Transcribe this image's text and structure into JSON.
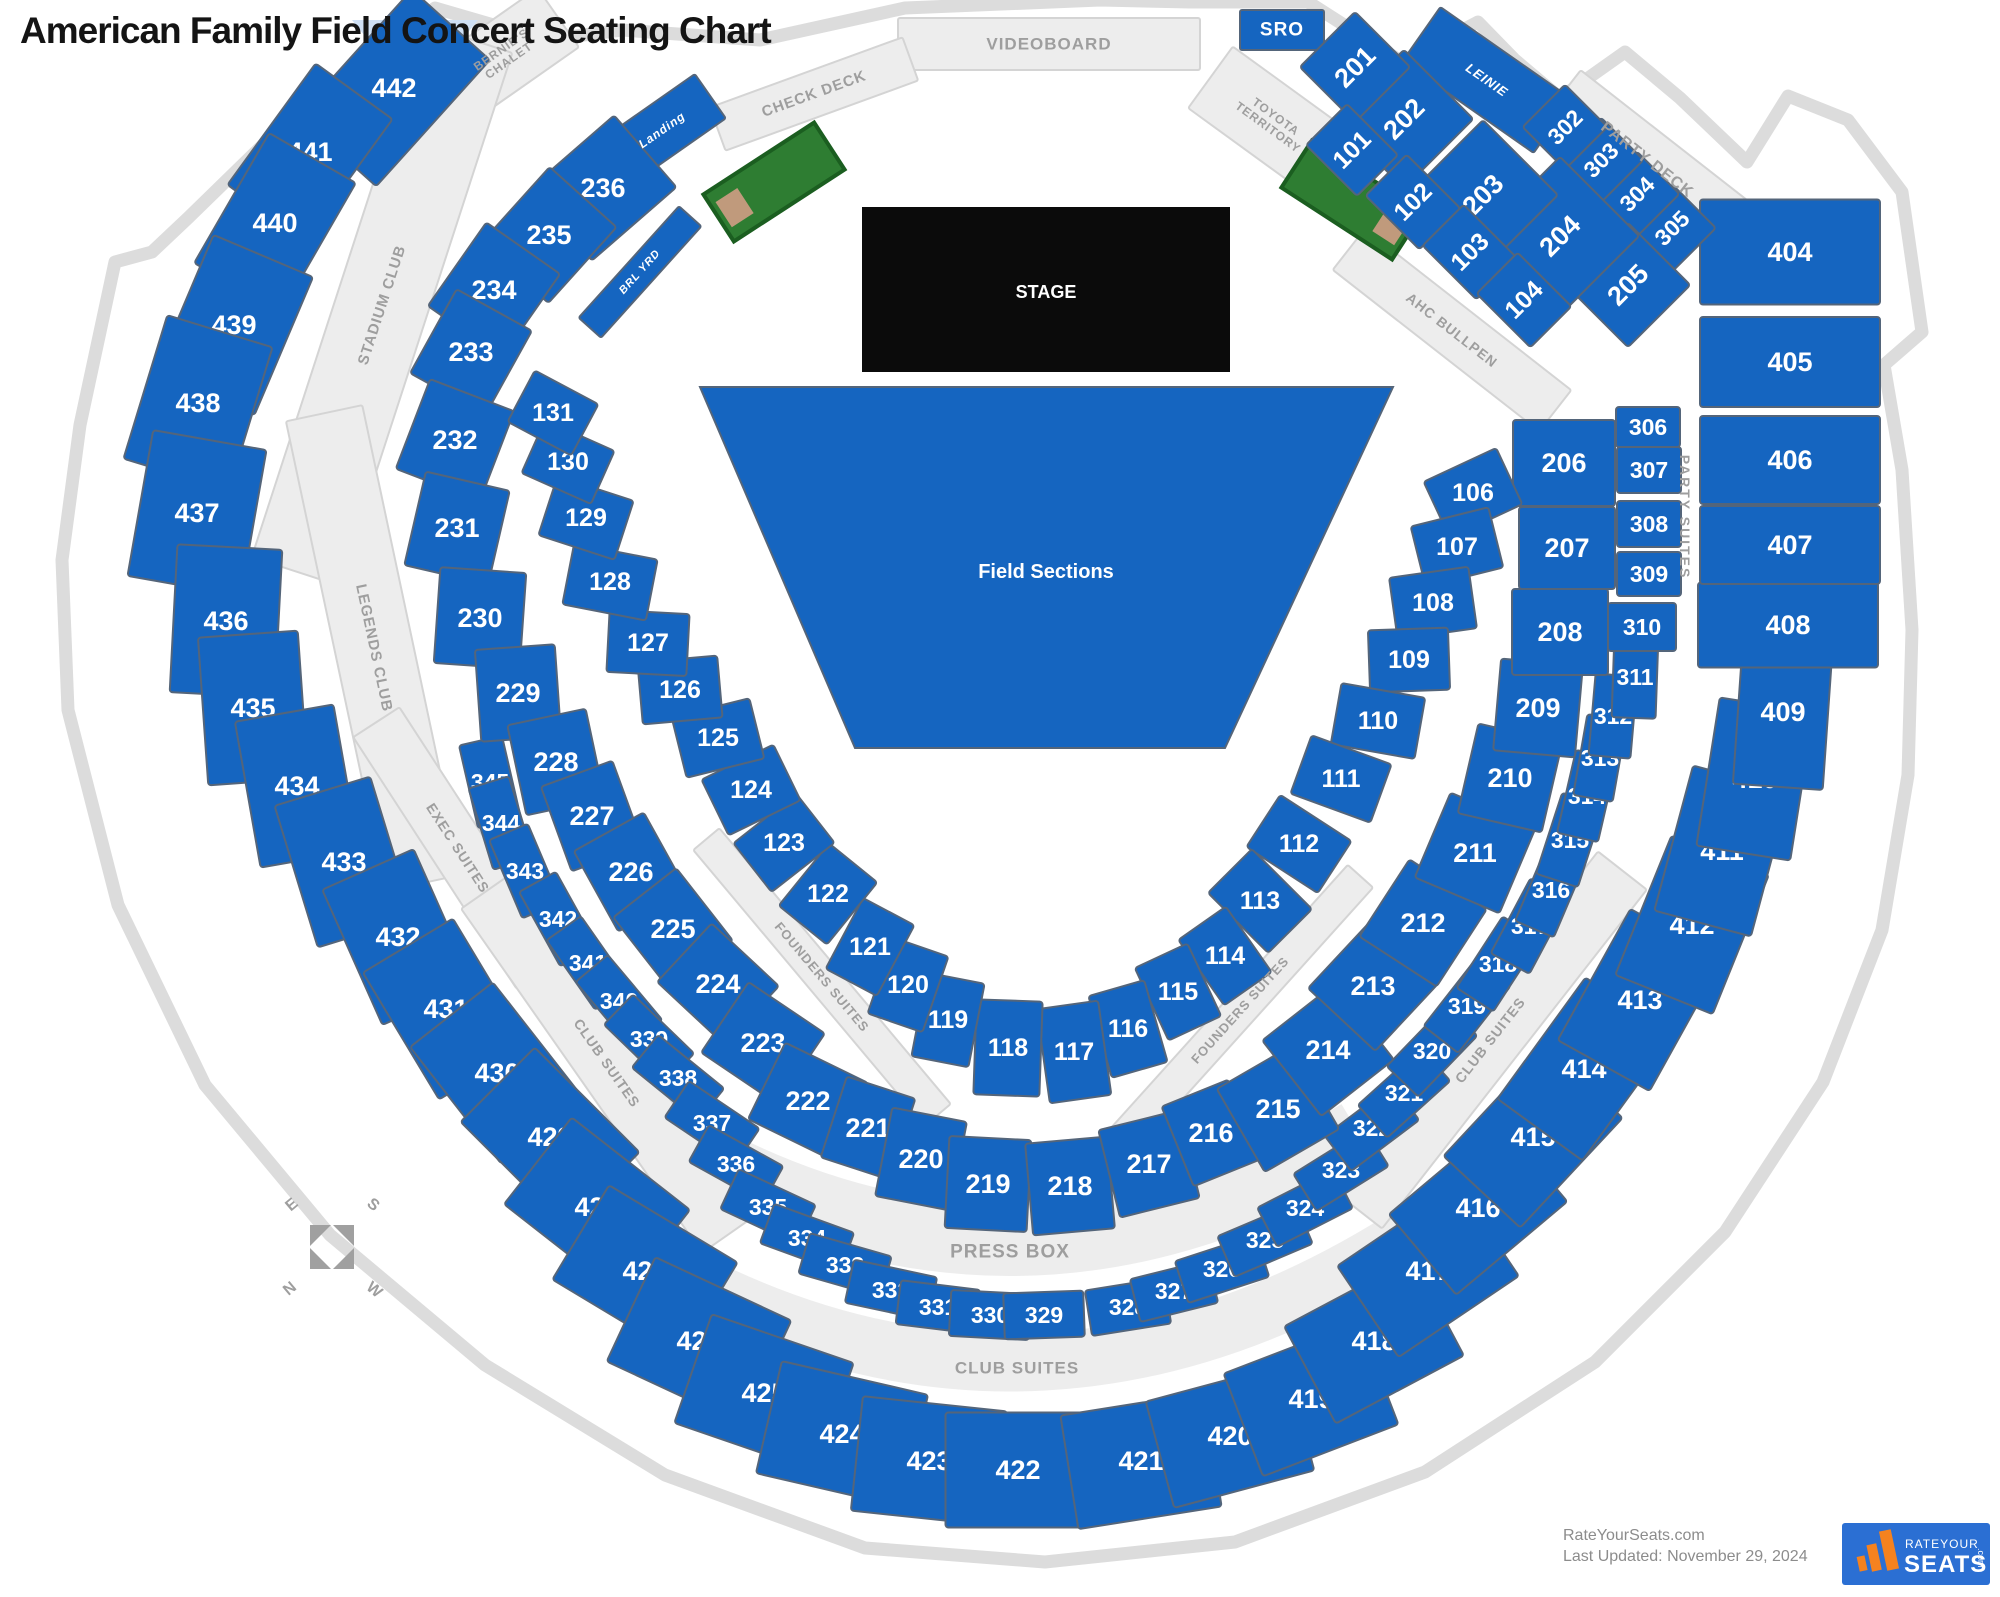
{
  "page": {
    "title": "American Family Field Concert Seating Chart"
  },
  "stage": {
    "label": "STAGE"
  },
  "field": {
    "label": "Field Sections"
  },
  "press_box": {
    "label": "PRESS BOX"
  },
  "club_suites_lower": {
    "label": "CLUB SUITES"
  },
  "compass": {
    "n": "N",
    "e": "E",
    "s": "S",
    "w": "W"
  },
  "footer": {
    "site": "RateYourSeats.com",
    "updated": "Last Updated: November 29, 2024"
  },
  "logo": {
    "rate_your": "RATEYOUR",
    "seats": "SEATS",
    "com": ".com"
  },
  "colors": {
    "section_blue": "#1565c0",
    "section_border": "#54657a",
    "band_gray": "#ededed",
    "band_border": "#d4d4d4",
    "gray_text": "#9e9e9e",
    "stage_black": "#0b0b0b",
    "bullpen_green": "#2e7d32",
    "bullpen_dark": "#1b5e20",
    "mound_tan": "#c09a7c",
    "logo_blue": "#2b6fd3",
    "logo_orange": "#f5821f",
    "outline_gray": "#dcdcdc",
    "light_blue": "#cfe0f5",
    "white": "#ffffff"
  },
  "bullpens": [
    {
      "cx": 774,
      "cy": 182,
      "w": 132,
      "h": 56,
      "rot": -33,
      "patch": "left"
    },
    {
      "cx": 1352,
      "cy": 200,
      "w": 132,
      "h": 56,
      "rot": 33,
      "patch": "right"
    }
  ],
  "bands": [
    [
      "VIDEOBOARD",
      1049,
      44,
      302,
      52,
      0,
      "gray",
      17
    ],
    [
      "SRO",
      1282,
      30,
      84,
      40,
      0,
      "blue",
      19
    ],
    [
      "CHECK DECK",
      814,
      94,
      205,
      46,
      -20,
      "gray",
      15
    ],
    [
      "BERNIE'S\nCHALET",
      505,
      55,
      130,
      72,
      -35,
      "gray",
      12
    ],
    [
      "TOYOTA\nTERRITORY",
      1272,
      122,
      152,
      76,
      36,
      "gray",
      12
    ],
    [
      "Landing",
      662,
      130,
      118,
      54,
      -35,
      "blueItalic",
      12
    ],
    [
      "BRL YRD",
      640,
      272,
      150,
      30,
      -48,
      "blueItalic",
      11
    ],
    [
      "LEINIE",
      1487,
      80,
      160,
      66,
      35,
      "blueItalic",
      13
    ],
    [
      "PARTY DECK",
      1647,
      160,
      215,
      60,
      38,
      "gray",
      16
    ],
    [
      "AHC BULLPEN",
      1452,
      330,
      262,
      52,
      38,
      "gray",
      14
    ],
    [
      "PARTY SUITES",
      1685,
      517,
      170,
      30,
      90,
      "textOnly",
      14
    ],
    [
      "STADIUM CLUB",
      382,
      305,
      560,
      92,
      -72,
      "gray",
      15
    ],
    [
      "LEGENDS CLUB",
      374,
      648,
      480,
      78,
      78,
      "gray",
      15
    ],
    [
      "EXEC SUITES",
      458,
      848,
      300,
      55,
      57,
      "gray",
      14
    ],
    [
      "CLUB SUITES",
      607,
      1063,
      420,
      62,
      55,
      "gray",
      14
    ],
    [
      "FOUNDERS SUITES",
      822,
      977,
      360,
      34,
      50,
      "gray",
      13
    ],
    [
      "FOUNDERS SUITES",
      1240,
      1010,
      360,
      34,
      -48,
      "gray",
      13
    ],
    [
      "CLUB SUITES",
      1490,
      1040,
      430,
      62,
      -52,
      "gray",
      14
    ]
  ],
  "sections": [
    [
      "442",
      394,
      88,
      170,
      105,
      -48
    ],
    [
      "441",
      310,
      152,
      150,
      95,
      -54
    ],
    [
      "440",
      275,
      223,
      150,
      100,
      -60
    ],
    [
      "439",
      234,
      325,
      150,
      108,
      -67
    ],
    [
      "438",
      198,
      403,
      150,
      110,
      -73
    ],
    [
      "437",
      197,
      513,
      148,
      115,
      -80
    ],
    [
      "436",
      226,
      621,
      148,
      105,
      -87
    ],
    [
      "435",
      253,
      708,
      148,
      100,
      86
    ],
    [
      "434",
      297,
      786,
      148,
      100,
      80
    ],
    [
      "433",
      344,
      862,
      148,
      100,
      73
    ],
    [
      "432",
      398,
      937,
      148,
      100,
      66
    ],
    [
      "431",
      446,
      1009,
      148,
      105,
      59
    ],
    [
      "430",
      497,
      1073,
      148,
      105,
      52
    ],
    [
      "429",
      550,
      1137,
      148,
      105,
      45
    ],
    [
      "428",
      597,
      1207,
      150,
      110,
      38
    ],
    [
      "427",
      645,
      1271,
      150,
      110,
      31
    ],
    [
      "426",
      699,
      1341,
      150,
      115,
      25
    ],
    [
      "425",
      764,
      1393,
      150,
      115,
      19
    ],
    [
      "424",
      842,
      1434,
      150,
      115,
      13
    ],
    [
      "423",
      929,
      1461,
      145,
      115,
      6
    ],
    [
      "422",
      1018,
      1470,
      145,
      115,
      0
    ],
    [
      "421",
      1141,
      1461,
      145,
      115,
      -9
    ],
    [
      "420",
      1230,
      1436,
      145,
      110,
      -15
    ],
    [
      "419",
      1311,
      1399,
      145,
      110,
      -21
    ],
    [
      "418",
      1374,
      1341,
      145,
      110,
      -28
    ],
    [
      "417",
      1428,
      1271,
      145,
      110,
      -34
    ],
    [
      "416",
      1478,
      1208,
      145,
      105,
      -40
    ],
    [
      "415",
      1533,
      1137,
      150,
      105,
      -47
    ],
    [
      "414",
      1584,
      1069,
      150,
      105,
      -54
    ],
    [
      "413",
      1640,
      1000,
      150,
      105,
      -61
    ],
    [
      "412",
      1692,
      925,
      150,
      105,
      -68
    ],
    [
      "411",
      1722,
      851,
      150,
      100,
      -75
    ],
    [
      "410",
      1755,
      779,
      150,
      95,
      -81
    ],
    [
      "409",
      1783,
      712,
      150,
      90,
      -86
    ],
    [
      "408",
      1788,
      625,
      180,
      85,
      0
    ],
    [
      "407",
      1790,
      545,
      180,
      78,
      0
    ],
    [
      "406",
      1790,
      460,
      180,
      88,
      0
    ],
    [
      "405",
      1790,
      362,
      180,
      90,
      0
    ],
    [
      "404",
      1790,
      252,
      180,
      105,
      0
    ],
    [
      "345",
      490,
      782,
      85,
      44,
      77
    ],
    [
      "344",
      501,
      823,
      85,
      42,
      73
    ],
    [
      "343",
      525,
      871,
      85,
      42,
      67
    ],
    [
      "342",
      558,
      919,
      85,
      42,
      61
    ],
    [
      "341",
      588,
      963,
      85,
      42,
      55
    ],
    [
      "340",
      619,
      1001,
      85,
      42,
      50
    ],
    [
      "339",
      649,
      1039,
      85,
      42,
      44
    ],
    [
      "338",
      678,
      1078,
      85,
      42,
      39
    ],
    [
      "337",
      712,
      1123,
      85,
      44,
      34
    ],
    [
      "336",
      736,
      1164,
      85,
      42,
      29
    ],
    [
      "335",
      768,
      1207,
      85,
      44,
      25
    ],
    [
      "334",
      807,
      1238,
      85,
      42,
      20
    ],
    [
      "333",
      845,
      1265,
      85,
      42,
      16
    ],
    [
      "332",
      891,
      1290,
      85,
      44,
      12
    ],
    [
      "331",
      938,
      1307,
      80,
      44,
      7
    ],
    [
      "330",
      990,
      1315,
      80,
      46,
      3
    ],
    [
      "329",
      1044,
      1315,
      80,
      46,
      -2
    ],
    [
      "328",
      1128,
      1307,
      80,
      46,
      -9
    ],
    [
      "327",
      1174,
      1291,
      80,
      44,
      -14
    ],
    [
      "326",
      1222,
      1269,
      85,
      44,
      -18
    ],
    [
      "325",
      1265,
      1240,
      85,
      44,
      -23
    ],
    [
      "324",
      1305,
      1208,
      85,
      44,
      -27
    ],
    [
      "323",
      1341,
      1170,
      85,
      44,
      -32
    ],
    [
      "322",
      1372,
      1128,
      85,
      44,
      -37
    ],
    [
      "321",
      1404,
      1093,
      85,
      44,
      -42
    ],
    [
      "320",
      1432,
      1051,
      85,
      44,
      -46
    ],
    [
      "319",
      1467,
      1006,
      85,
      44,
      -52
    ],
    [
      "318",
      1498,
      964,
      85,
      44,
      -57
    ],
    [
      "317",
      1530,
      926,
      85,
      44,
      -62
    ],
    [
      "316",
      1551,
      890,
      85,
      42,
      -67
    ],
    [
      "315",
      1570,
      840,
      85,
      44,
      -72
    ],
    [
      "314",
      1587,
      796,
      85,
      42,
      -77
    ],
    [
      "313",
      1600,
      758,
      82,
      40,
      -80
    ],
    [
      "312",
      1613,
      716,
      82,
      42,
      -85
    ],
    [
      "311",
      1635,
      677,
      82,
      44,
      -88
    ],
    [
      "310",
      1642,
      627,
      68,
      48,
      0
    ],
    [
      "309",
      1649,
      574,
      64,
      44,
      0
    ],
    [
      "308",
      1649,
      524,
      64,
      46,
      0
    ],
    [
      "307",
      1649,
      470,
      64,
      46,
      0
    ],
    [
      "306",
      1648,
      427,
      64,
      40,
      0
    ],
    [
      "305",
      1672,
      228,
      62,
      62,
      -45,
      -45
    ],
    [
      "304",
      1637,
      194,
      60,
      60,
      -45,
      -45
    ],
    [
      "303",
      1601,
      160,
      60,
      60,
      -45,
      -45
    ],
    [
      "302",
      1565,
      127,
      60,
      60,
      -45,
      -45
    ],
    [
      "236",
      603,
      188,
      112,
      95,
      -41
    ],
    [
      "235",
      549,
      235,
      102,
      90,
      -48
    ],
    [
      "234",
      494,
      290,
      102,
      90,
      -55
    ],
    [
      "233",
      471,
      352,
      96,
      86,
      -61
    ],
    [
      "232",
      455,
      440,
      96,
      90,
      -69
    ],
    [
      "231",
      457,
      528,
      96,
      86,
      -77
    ],
    [
      "230",
      480,
      618,
      96,
      86,
      -86
    ],
    [
      "229",
      518,
      693,
      92,
      80,
      86
    ],
    [
      "228",
      556,
      762,
      92,
      80,
      78
    ],
    [
      "227",
      592,
      816,
      90,
      76,
      70
    ],
    [
      "226",
      631,
      872,
      92,
      80,
      61
    ],
    [
      "225",
      673,
      929,
      92,
      80,
      52
    ],
    [
      "224",
      718,
      984,
      92,
      80,
      43
    ],
    [
      "223",
      763,
      1043,
      92,
      85,
      34
    ],
    [
      "222",
      808,
      1101,
      92,
      85,
      26
    ],
    [
      "221",
      868,
      1128,
      72,
      85,
      18
    ],
    [
      "220",
      921,
      1159,
      76,
      90,
      11
    ],
    [
      "219",
      988,
      1184,
      82,
      92,
      3
    ],
    [
      "218",
      1070,
      1186,
      82,
      92,
      -5
    ],
    [
      "217",
      1149,
      1164,
      82,
      90,
      -14
    ],
    [
      "216",
      1211,
      1133,
      72,
      86,
      -22
    ],
    [
      "215",
      1278,
      1109,
      86,
      96,
      -30
    ],
    [
      "214",
      1328,
      1050,
      92,
      96,
      -38
    ],
    [
      "213",
      1373,
      986,
      92,
      92,
      -47
    ],
    [
      "212",
      1423,
      923,
      92,
      92,
      -57
    ],
    [
      "211",
      1475,
      853,
      92,
      92,
      -67
    ],
    [
      "210",
      1510,
      778,
      92,
      86,
      -77
    ],
    [
      "209",
      1538,
      708,
      92,
      82,
      -85
    ],
    [
      "208",
      1560,
      632,
      96,
      86,
      0
    ],
    [
      "207",
      1567,
      548,
      96,
      82,
      0
    ],
    [
      "206",
      1564,
      463,
      102,
      86,
      0
    ],
    [
      "205",
      1628,
      285,
      88,
      88,
      -45,
      -45
    ],
    [
      "204",
      1560,
      236,
      112,
      112,
      -45,
      -45
    ],
    [
      "203",
      1483,
      195,
      106,
      106,
      -45,
      -45
    ],
    [
      "202",
      1404,
      119,
      98,
      98,
      -45,
      -45
    ],
    [
      "201",
      1355,
      67,
      78,
      78,
      -45,
      -45
    ],
    [
      "101",
      1352,
      150,
      58,
      72,
      -45,
      -45
    ],
    [
      "102",
      1413,
      202,
      58,
      76,
      -45,
      -45
    ],
    [
      "103",
      1470,
      252,
      58,
      76,
      -45,
      -45
    ],
    [
      "104",
      1524,
      300,
      58,
      76,
      -45,
      -45
    ],
    [
      "106",
      1473,
      493,
      62,
      80,
      65
    ],
    [
      "107",
      1457,
      547,
      62,
      80,
      76
    ],
    [
      "108",
      1433,
      603,
      62,
      80,
      82
    ],
    [
      "109",
      1409,
      660,
      62,
      80,
      88
    ],
    [
      "110",
      1378,
      721,
      62,
      85,
      -80
    ],
    [
      "111",
      1341,
      779,
      62,
      85,
      -70
    ],
    [
      "112",
      1299,
      844,
      62,
      85,
      -57
    ],
    [
      "113",
      1260,
      901,
      62,
      85,
      -45
    ],
    [
      "114",
      1225,
      956,
      58,
      80,
      -35
    ],
    [
      "115",
      1178,
      992,
      58,
      80,
      -25
    ],
    [
      "116",
      1128,
      1029,
      58,
      85,
      -16
    ],
    [
      "117",
      1074,
      1052,
      62,
      95,
      -8
    ],
    [
      "118",
      1008,
      1048,
      66,
      95,
      2
    ],
    [
      "119",
      948,
      1020,
      58,
      85,
      11
    ],
    [
      "120",
      908,
      985,
      58,
      80,
      19
    ],
    [
      "121",
      870,
      947,
      58,
      80,
      28
    ],
    [
      "122",
      828,
      894,
      62,
      80,
      39
    ],
    [
      "123",
      784,
      843,
      62,
      80,
      52
    ],
    [
      "124",
      751,
      790,
      62,
      80,
      64
    ],
    [
      "125",
      718,
      738,
      62,
      80,
      76
    ],
    [
      "126",
      680,
      690,
      62,
      80,
      85
    ],
    [
      "127",
      648,
      643,
      62,
      80,
      -87
    ],
    [
      "128",
      610,
      582,
      62,
      85,
      -79
    ],
    [
      "129",
      586,
      518,
      62,
      80,
      -72
    ],
    [
      "130",
      568,
      462,
      58,
      76,
      -66
    ],
    [
      "131",
      553,
      413,
      58,
      72,
      -62
    ]
  ]
}
